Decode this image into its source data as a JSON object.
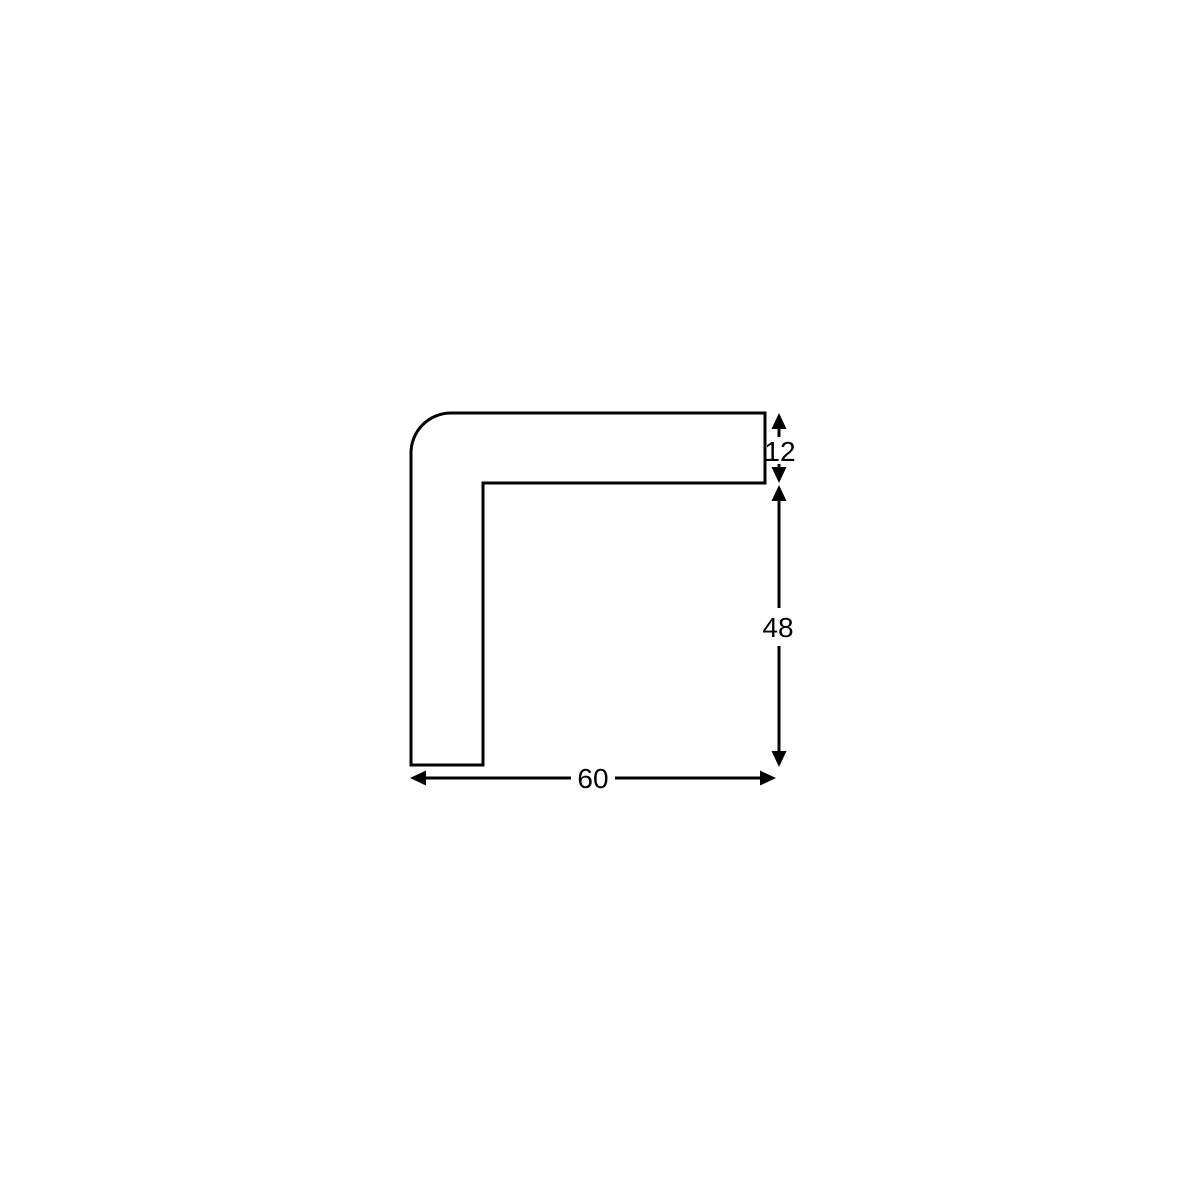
{
  "canvas": {
    "background_color": "#ffffff",
    "line_color": "#000000"
  },
  "diagram": {
    "name": "corner-profile-cross-section",
    "description": "Technical line drawing of an L-shaped corner protection profile cross-section with a rounded outer corner and three dimension callouts",
    "dimensions": {
      "top_thickness": "12",
      "right_height": "48",
      "bottom_width": "60"
    }
  }
}
